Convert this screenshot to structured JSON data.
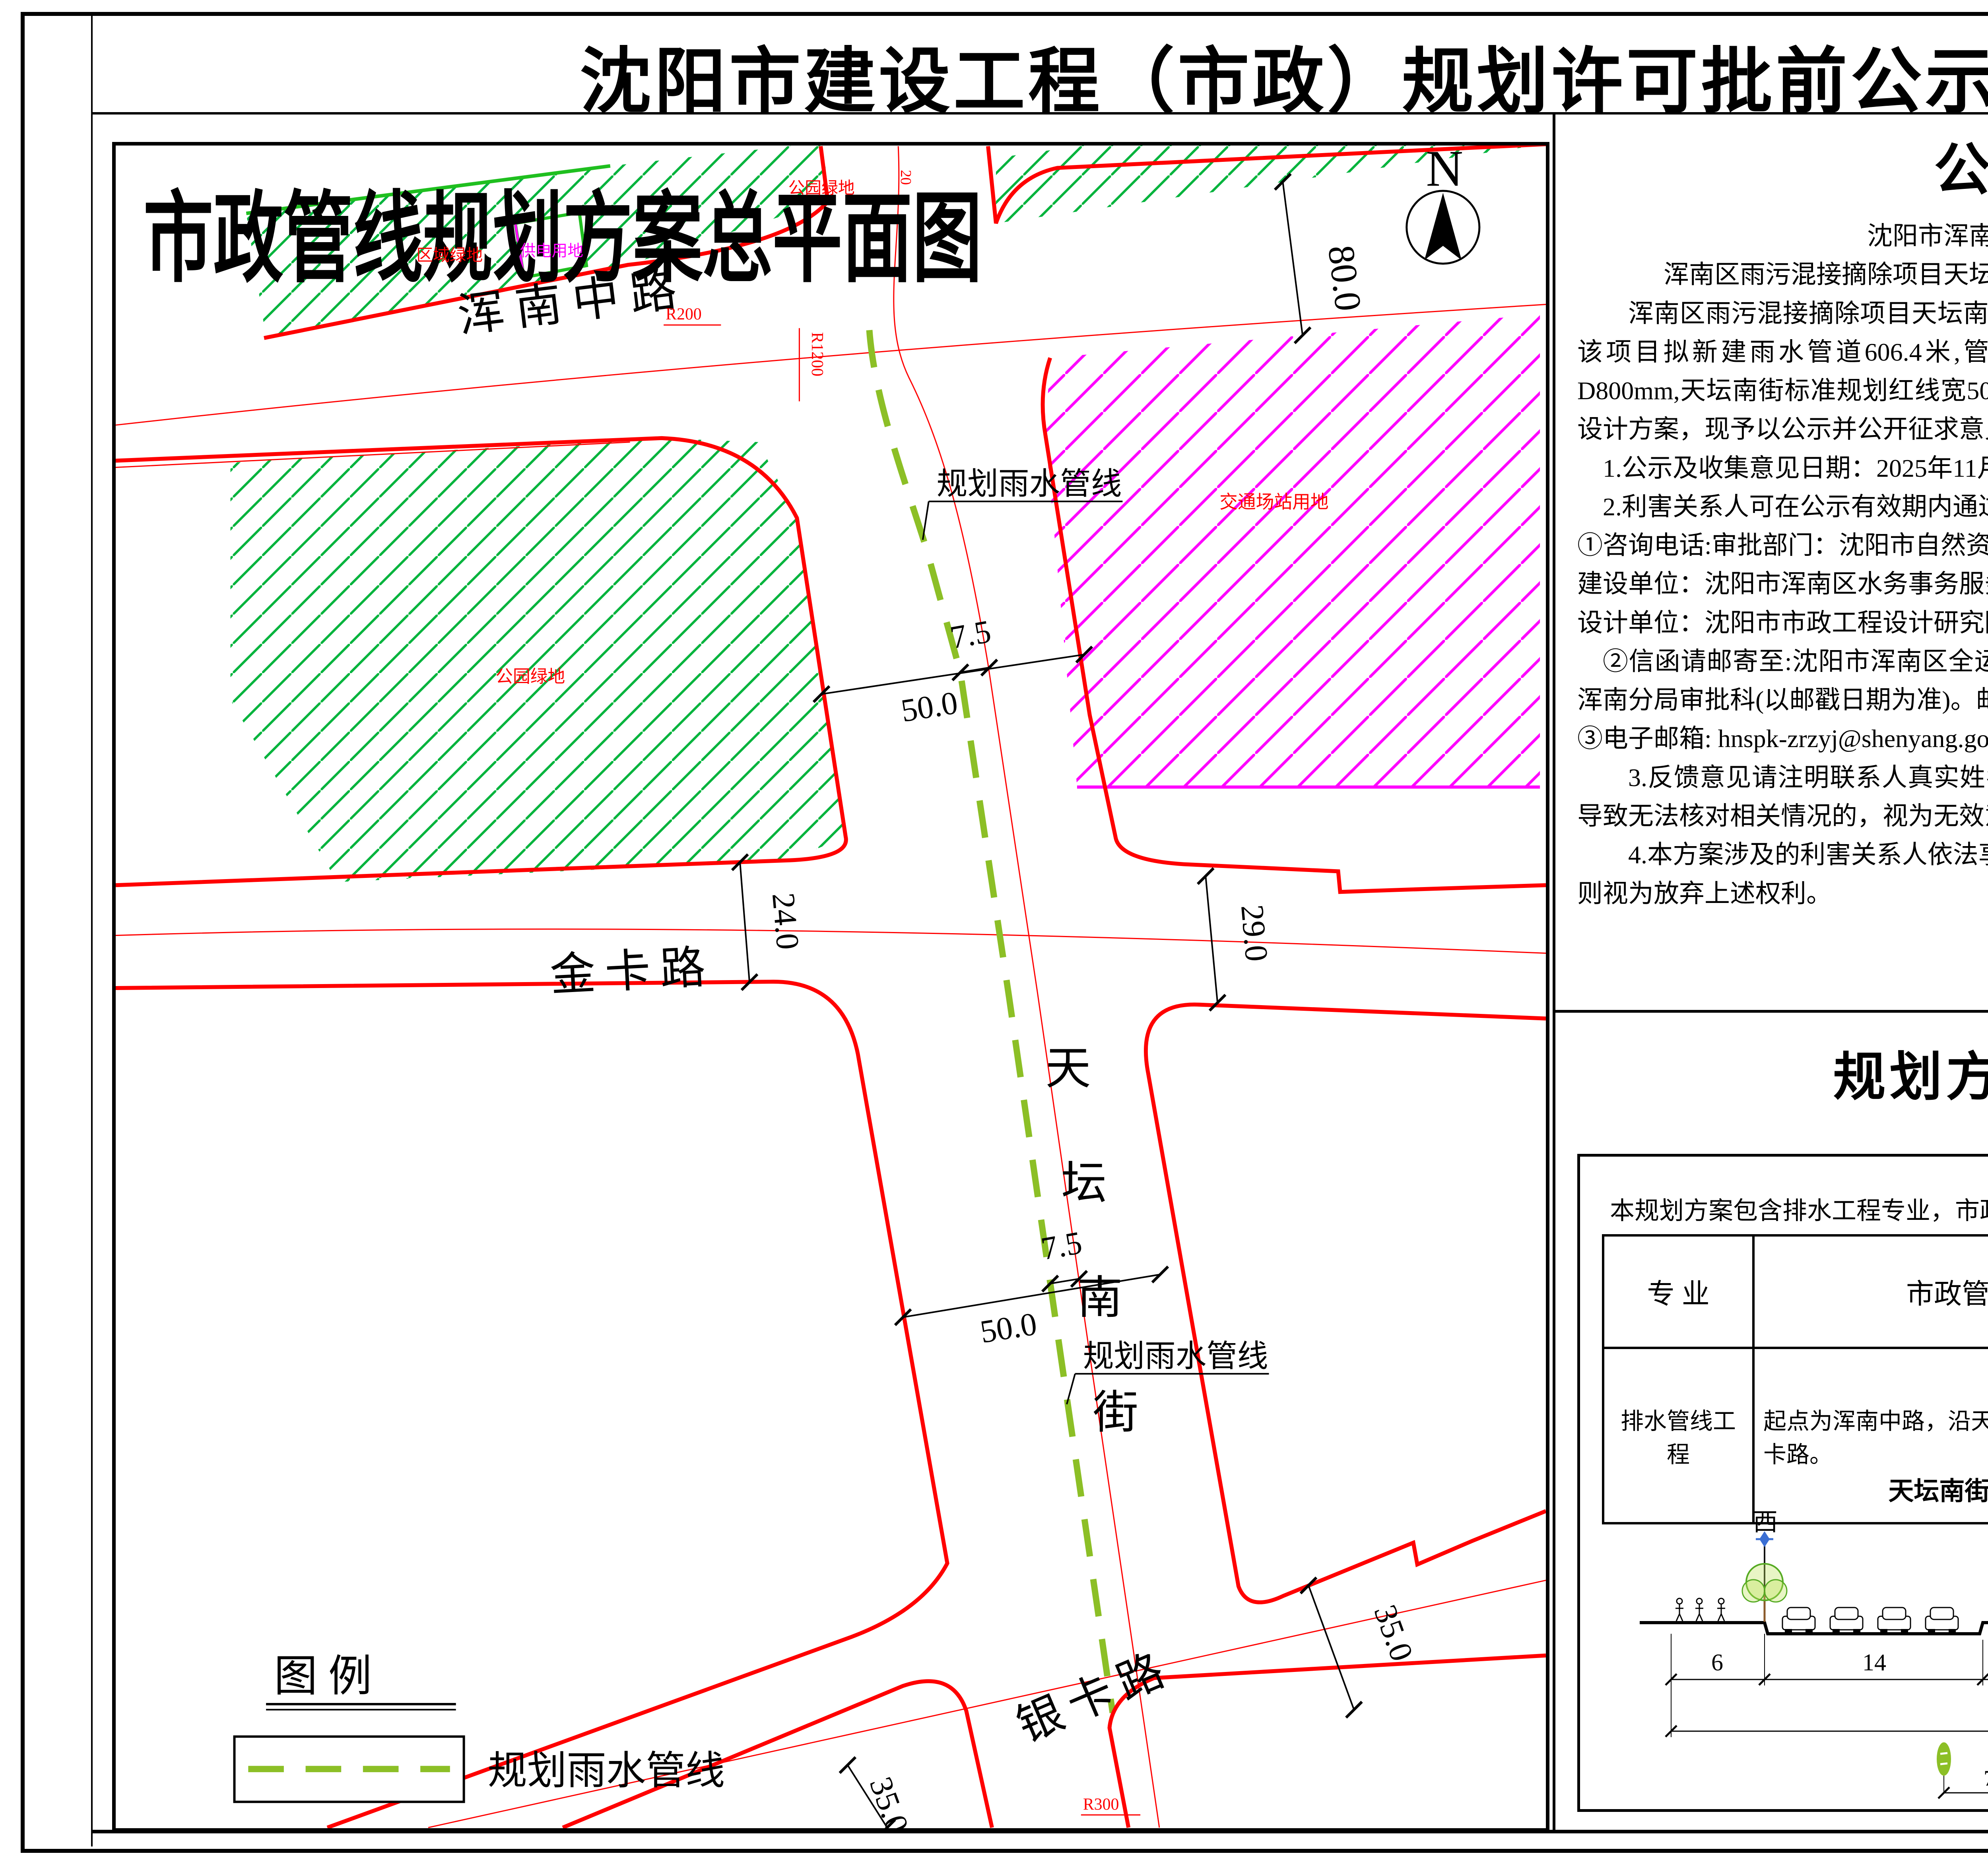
{
  "board": {
    "title": "沈阳市建设工程（市政）规划许可批前公示板"
  },
  "map": {
    "title": "市政管线规划方案总平面图",
    "north": "N",
    "roads": {
      "hunnan": "浑南中路",
      "jinka": "金卡路",
      "yinka": "银卡路",
      "tiantan_chars": [
        "天",
        "坛",
        "南",
        "街"
      ]
    },
    "parcels": {
      "regional": "区域绿地",
      "power": "供电用地",
      "park_top": "公园绿地",
      "park_left": "公园绿地",
      "transport": "交通场站用地"
    },
    "ann": {
      "pipeline": "规划雨水管线",
      "r200": "R200",
      "r1200": "R1200",
      "r300": "R300",
      "dim20": "20",
      "dim80": "80.0",
      "dim75": "7.5",
      "dim50": "50.0",
      "dim24": "24.0",
      "dim29": "29.0",
      "dim35": "35.0"
    },
    "legend": {
      "heading": "图    例",
      "item": "规划雨水管线"
    }
  },
  "notice": {
    "title": "公示信息",
    "lines": [
      "沈阳市浑南区水务事务服务中心的",
      "浑南区雨污混接摘除项目天坛南街(银卡路-浑南中路)规划许可批前公示",
      "浑南区雨污混接摘除项目天坛南街（银卡路-浑南中路）工程位于沈阳市浑南区，该项目拟新建雨水管道606.4米,管线线位位于道路中心线以西7.5m,管线管径为D800mm,天坛南街标准规划红线宽50米。按照相关技术标准和规范完成建设工程规划设计方案，现予以公示并公开征求意见。",
      "1.公示及收集意见日期：2025年11月25日—2025年12月3日（7个工作日）",
      "2.利害关系人可在公示有效期内通过以下途径咨询或提出意见：",
      "①咨询电话:审批部门：沈阳市自然资源局  024-84821869;",
      "建设单位：沈阳市浑南区水务事务服务中心 024-24211049;",
      "设计单位：沈阳市市政工程设计研究院有限公司 024-23892785;",
      "②信函请邮寄至:沈阳市浑南区全运路109号（创新天地H座9楼）沈阳市自然资源局浑南分局审批科(以邮戳日期为准)。邮编：110167。",
      "③电子邮箱: hnspk-zrzyj@shenyang.gov.cn",
      "3.反馈意见请注明联系人真实姓名、电话、地址等信息;如因信息不完整或不真实导致无法核对相关情况的，视为无效意见。",
      "4.本方案涉及的利害关系人依法享有陈述、申辩以及申请听证等权利，逾期未申请则视为放弃上述权利。",
      "沈阳市浑南区水务事务服务中心",
      "沈阳市自然资源局",
      "2025年11月25日"
    ]
  },
  "plan": {
    "title": "规划方案主要内容",
    "intro": "本规划方案包含排水工程专业，市政管线主要内容见下表：",
    "table": {
      "headers": [
        "专    业",
        "市政管线接驳点",
        "新建市政管线规格"
      ],
      "row": [
        "排水管线工程",
        "起点为浑南中路，沿天坛南街向南敷设，至银卡路。",
        "拟建雨水管线606.4米，雨水管径为D800mm。"
      ]
    },
    "section": {
      "title": "天坛南街（银卡路-浑南中路）",
      "west": "西",
      "east": "东",
      "dims": [
        "6",
        "14",
        "10",
        "14",
        "6"
      ],
      "total": "50",
      "offset": "7.5",
      "legend_title": "图例",
      "legend_item": "规划雨水管线"
    }
  },
  "colors": {
    "boundary_red": "#ff0000",
    "green_hatch": "#00b33c",
    "magenta_hatch": "#ff00ff",
    "pipeline_green": "#8cbf26",
    "light_blue": "#3b6fd4"
  }
}
